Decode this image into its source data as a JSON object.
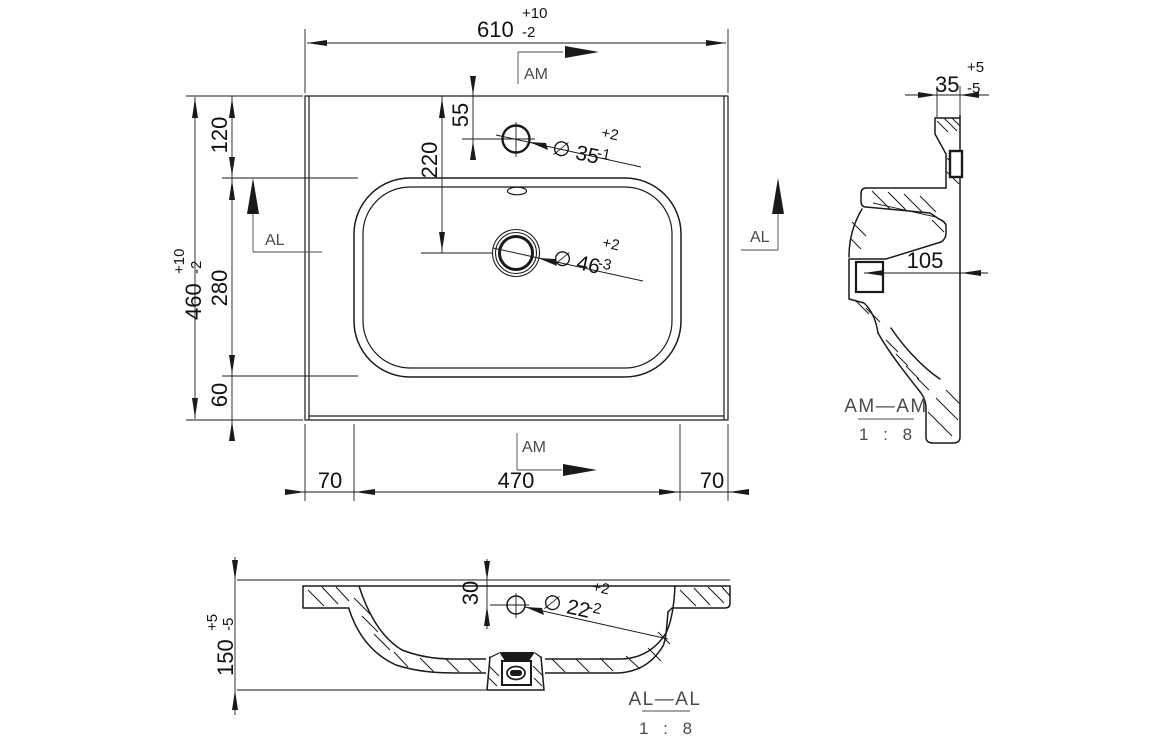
{
  "plan": {
    "overall_width": {
      "value": "610",
      "plus": "+10",
      "minus": "-2"
    },
    "overall_depth": {
      "value": "460",
      "plus": "+10",
      "minus": "-2"
    },
    "back_to_basin": "120",
    "basin_depth": "280",
    "basin_to_front": "60",
    "tap_hole_offset": "55",
    "drain_offset": "220",
    "left_margin": "70",
    "basin_width": "470",
    "right_margin": "70",
    "tap_hole": {
      "label": "∅ 35",
      "plus": "+2",
      "minus": "-1"
    },
    "drain_hole": {
      "label": "∅ 46",
      "plus": "+2",
      "minus": "-3"
    }
  },
  "side_section": {
    "title": "AM—AM",
    "scale": "1 : 8",
    "edge_thickness": {
      "value": "35",
      "plus": "+5",
      "minus": "-5"
    },
    "drain_depth": "105"
  },
  "front_section": {
    "title": "AL—AL",
    "scale": "1 : 8",
    "total_height": {
      "value": "150",
      "plus": "+5",
      "minus": "-5"
    },
    "overflow_offset": "30",
    "overflow_hole": {
      "label": "∅ 22",
      "plus": "+2",
      "minus": "-2"
    }
  },
  "markers": {
    "am": "AM",
    "al": "AL"
  }
}
